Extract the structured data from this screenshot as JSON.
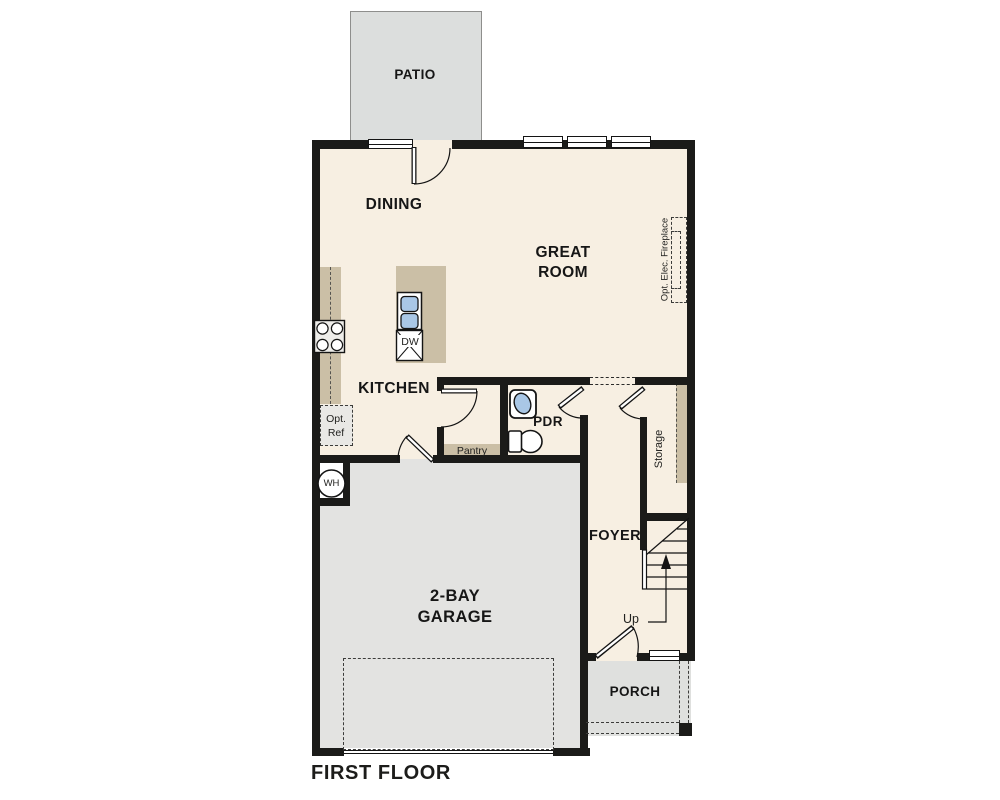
{
  "plan": {
    "title": "FIRST FLOOR",
    "rooms": {
      "patio": "PATIO",
      "dining": "DINING",
      "great_room": "GREAT ROOM",
      "kitchen": "KITCHEN",
      "powder_room": "PDR",
      "pantry": "Pantry",
      "storage": "Storage",
      "foyer": "FOYER",
      "garage": "2-BAY GARAGE",
      "porch": "PORCH"
    },
    "annotations": {
      "optional_fireplace": "Opt. Elec. Fireplace",
      "optional_refrigerator": "Opt. Ref",
      "water_heater": "WH",
      "dishwasher": "DW",
      "stairs_direction": "Up"
    },
    "colors": {
      "wall": "#1b1b19",
      "interior_floor": "#f7efe2",
      "exterior_concrete": "#e1e2e0",
      "casework": "#cbbfa6",
      "fixture_blue": "#a9c7e6",
      "background": "#ffffff"
    }
  }
}
